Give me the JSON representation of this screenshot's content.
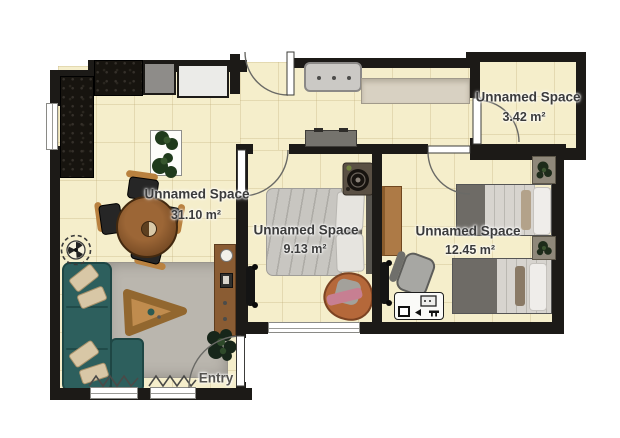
{
  "plan": {
    "entry_label": "Entry",
    "rooms": [
      {
        "id": "living-dining",
        "name": "Unnamed Space",
        "area": "31.10 m²"
      },
      {
        "id": "bedroom-small",
        "name": "Unnamed Space",
        "area": "9.13 m²"
      },
      {
        "id": "bedroom-twin",
        "name": "Unnamed Space",
        "area": "12.45 m²"
      },
      {
        "id": "storage-room",
        "name": "Unnamed Space",
        "area": "3.42 m²"
      }
    ],
    "colors": {
      "floor": "#f5eecb",
      "wall": "#1c1a17",
      "sofa_teal": "#2d5f5d",
      "rug_gray": "#bab6ae",
      "wood_brown": "#8a5c33",
      "label_text": "#3b3b3b"
    }
  }
}
